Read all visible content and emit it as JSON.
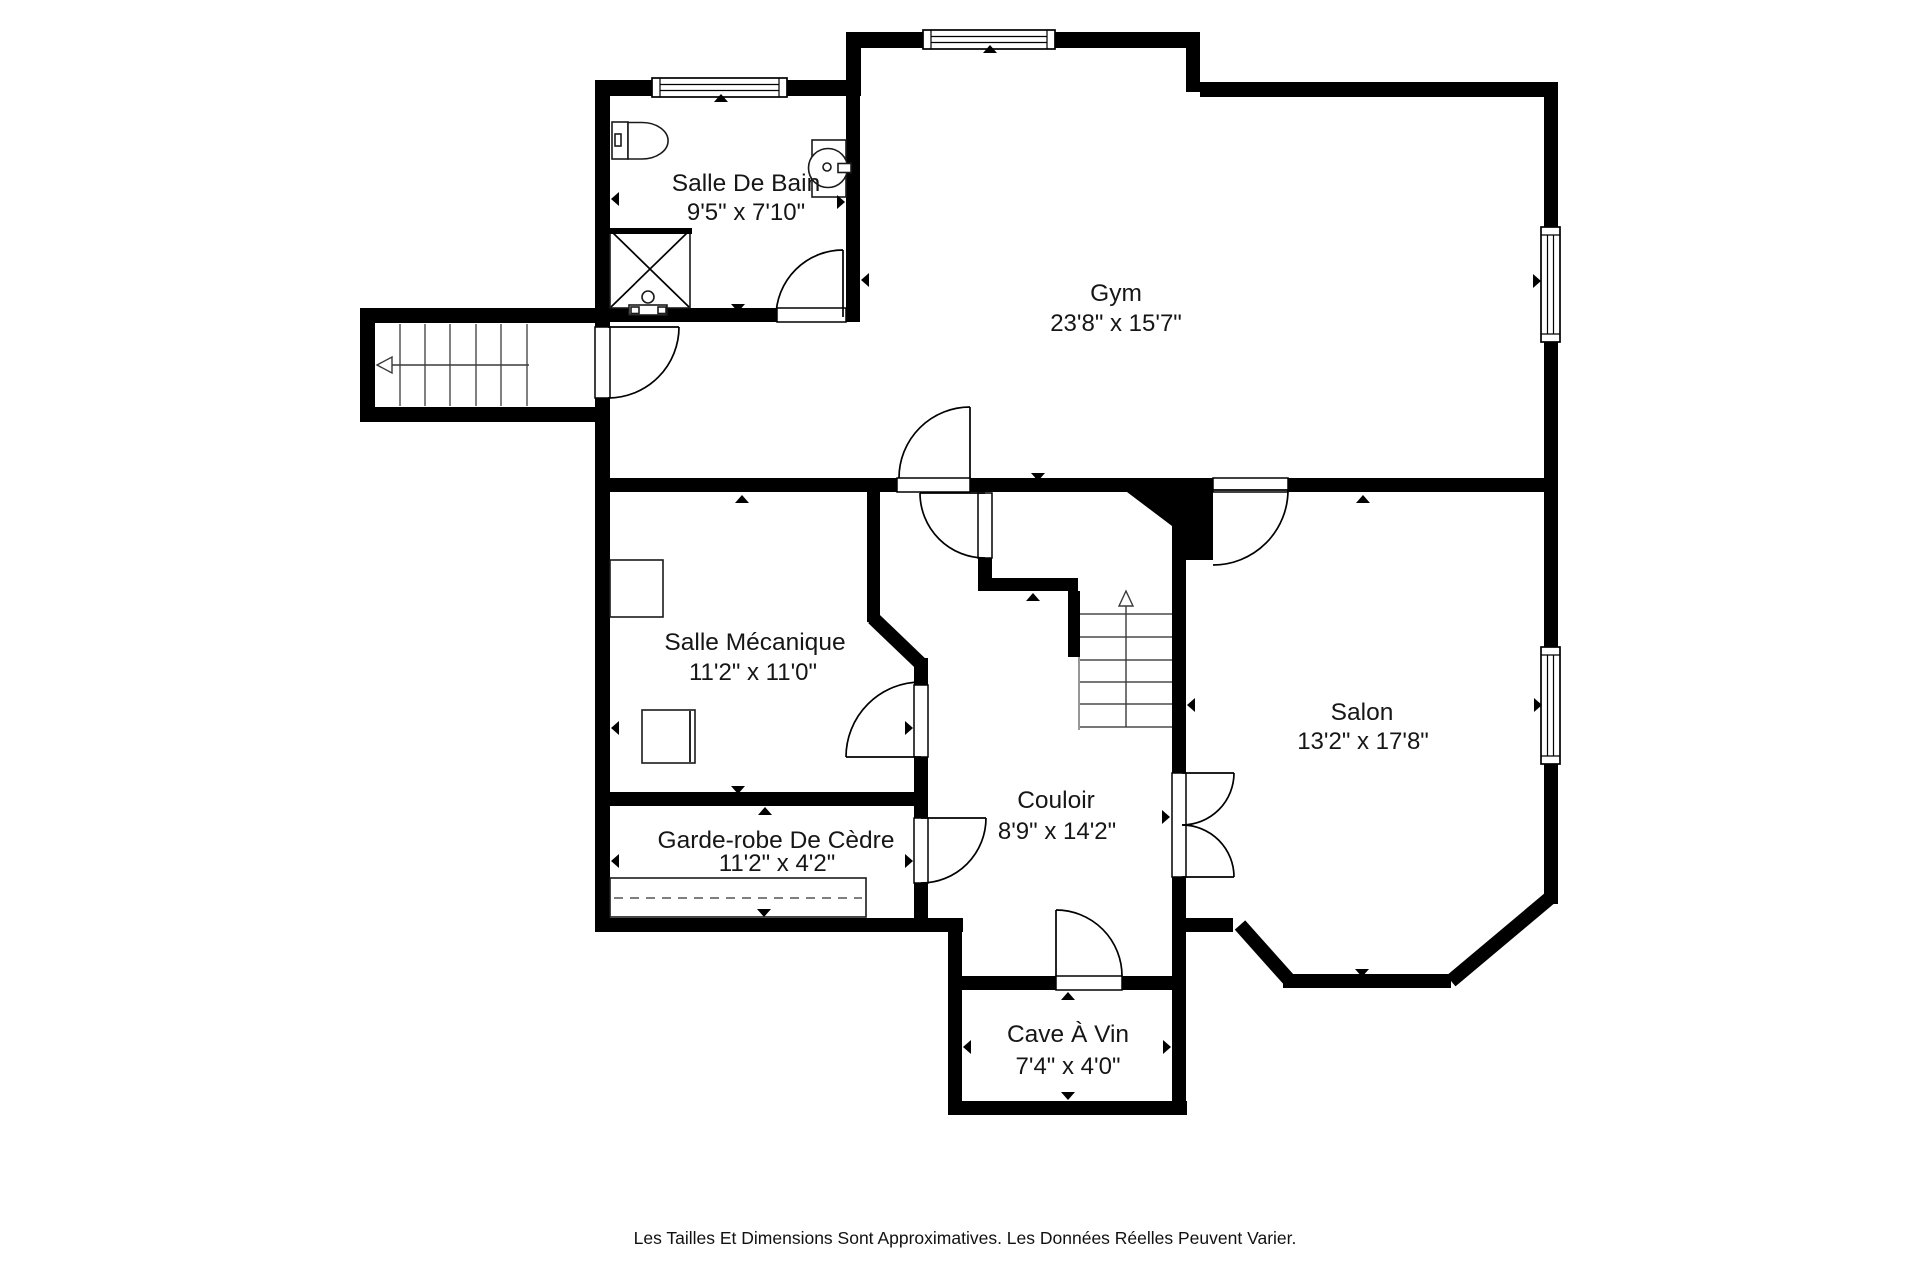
{
  "plan": {
    "type": "floor-plan",
    "language": "French",
    "rooms": [
      {
        "name": "Salle De Bain",
        "dims": "9'5\" x 7'10\""
      },
      {
        "name": "Gym",
        "dims": "23'8\" x 15'7\""
      },
      {
        "name": "Salle Mécanique",
        "dims": "11'2\" x 11'0\""
      },
      {
        "name": "Couloir",
        "dims": "8'9\" x 14'2\""
      },
      {
        "name": "Salon",
        "dims": "13'2\" x 17'8\""
      },
      {
        "name": "Garde-robe De Cèdre",
        "dims": "11'2\" x 4'2\""
      },
      {
        "name": "Cave À Vin",
        "dims": "7'4\" x 4'0\""
      }
    ],
    "footer": "Les Tailles Et Dimensions Sont Approximatives. Les Données Réelles Peuvent Varier.",
    "colors": {
      "walls": "#000000",
      "background": "#ffffff",
      "text": "#161616"
    }
  }
}
